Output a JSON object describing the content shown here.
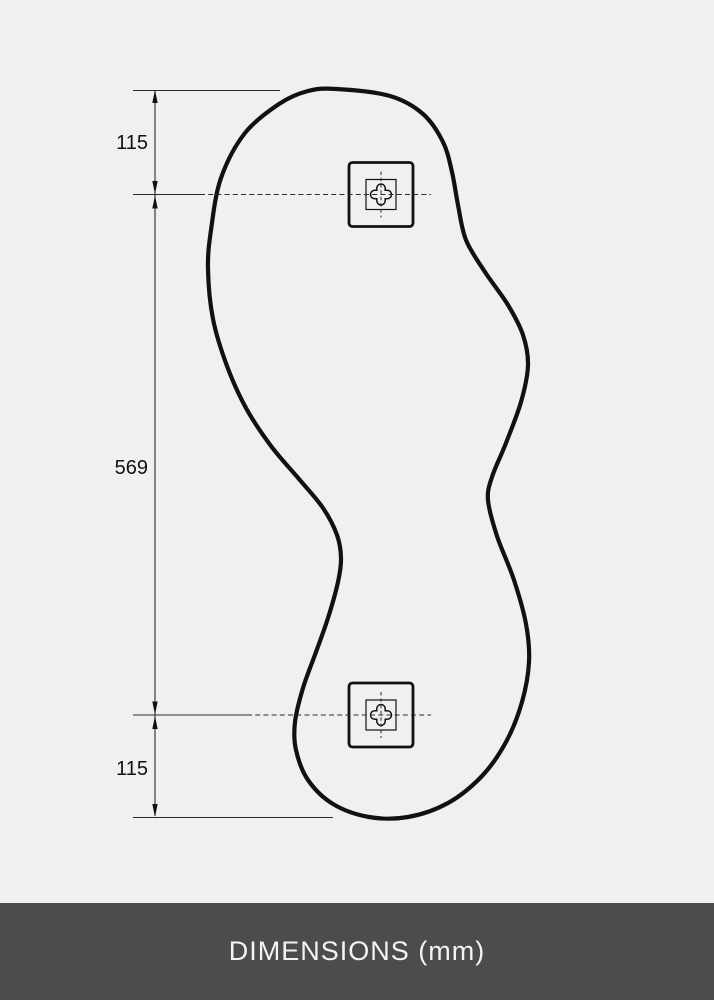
{
  "footer": {
    "label": "DIMENSIONS (mm)"
  },
  "dimension_labels": {
    "top": "115",
    "middle": "569",
    "bottom": "115"
  },
  "colors": {
    "background": "#f0f0f1",
    "line": "#111111",
    "footer_background": "#4c4c4c",
    "footer_text": "#f3f3f3"
  },
  "drawing": {
    "outline_points": [
      [
        337,
        89
      ],
      [
        390,
        96
      ],
      [
        423,
        114
      ],
      [
        443,
        142
      ],
      [
        452,
        172
      ],
      [
        458,
        205
      ],
      [
        466,
        240
      ],
      [
        485,
        272
      ],
      [
        508,
        305
      ],
      [
        523,
        335
      ],
      [
        528,
        365
      ],
      [
        521,
        402
      ],
      [
        506,
        443
      ],
      [
        492,
        477
      ],
      [
        488,
        500
      ],
      [
        497,
        536
      ],
      [
        514,
        580
      ],
      [
        526,
        624
      ],
      [
        529,
        662
      ],
      [
        522,
        702
      ],
      [
        506,
        742
      ],
      [
        482,
        776
      ],
      [
        448,
        803
      ],
      [
        408,
        817
      ],
      [
        369,
        817
      ],
      [
        333,
        804
      ],
      [
        308,
        780
      ],
      [
        296,
        750
      ],
      [
        295,
        722
      ],
      [
        303,
        688
      ],
      [
        316,
        652
      ],
      [
        328,
        618
      ],
      [
        338,
        582
      ],
      [
        341,
        558
      ],
      [
        337,
        535
      ],
      [
        323,
        508
      ],
      [
        299,
        479
      ],
      [
        271,
        446
      ],
      [
        246,
        408
      ],
      [
        227,
        366
      ],
      [
        213,
        319
      ],
      [
        208,
        269
      ],
      [
        211,
        230
      ],
      [
        221,
        178
      ],
      [
        245,
        133
      ],
      [
        279,
        104
      ],
      [
        308,
        91
      ]
    ],
    "brackets": [
      {
        "x": 381,
        "y": 194.5
      },
      {
        "x": 381,
        "y": 715
      }
    ]
  }
}
